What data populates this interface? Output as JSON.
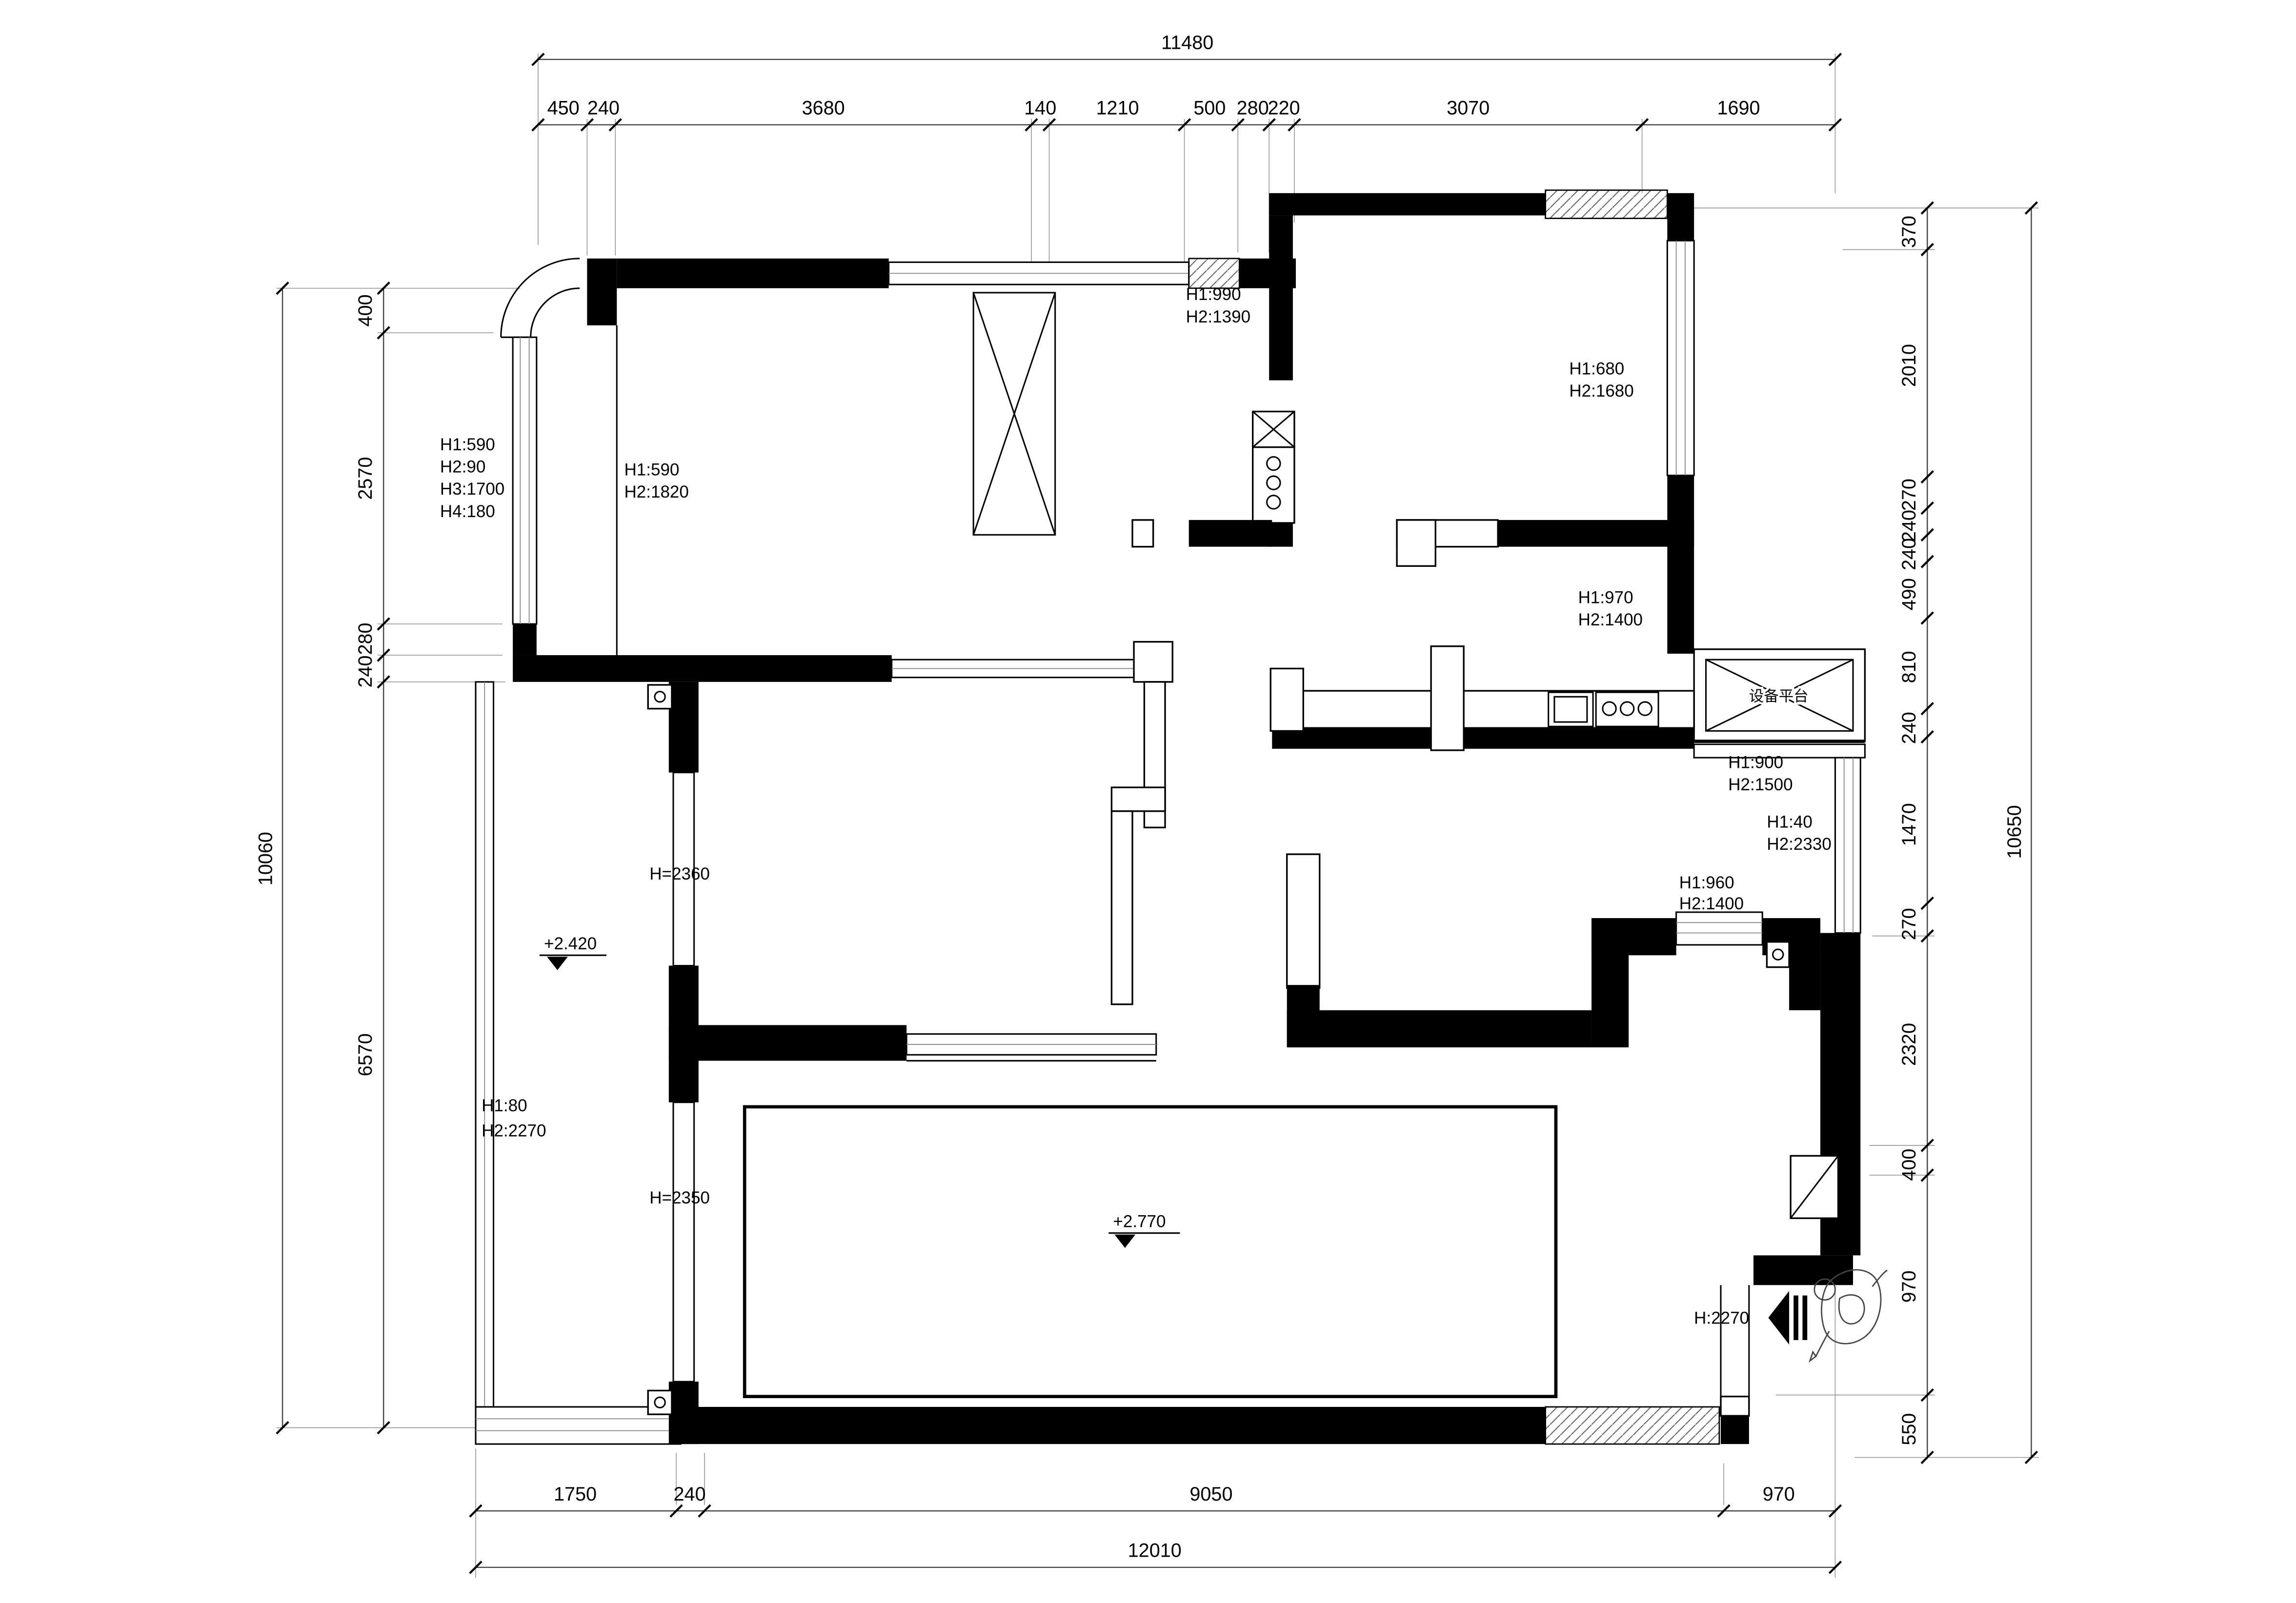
{
  "drawing_type": "floor-plan",
  "dims": {
    "top_total": "11480",
    "top_segments": [
      "450",
      "240",
      "3680",
      "140",
      "1210",
      "500",
      "280",
      "220",
      "3070",
      "1690"
    ],
    "bottom_segments": [
      "1750",
      "240",
      "9050",
      "970"
    ],
    "bottom_total": "12010",
    "left_outer_total": "10060",
    "left_segments": [
      "400",
      "2570",
      "280",
      "240",
      "6570"
    ],
    "right_outer_total": "10650",
    "right_segments": [
      "370",
      "2010",
      "270",
      "240",
      "240",
      "490",
      "810",
      "240",
      "1470",
      "270",
      "2320",
      "400",
      "970",
      "550"
    ]
  },
  "annotations": {
    "win_top_center": [
      "H1:990",
      "H2:1390"
    ],
    "win_top_right": [
      "H1:680",
      "H2:1680"
    ],
    "win_left_upper": [
      "H1:590",
      "H2:90",
      "H3:1700",
      "H4:180"
    ],
    "win_topleft_room": [
      "H1:590",
      "H2:1820"
    ],
    "win_mid_right": [
      "H1:970",
      "H2:1400"
    ],
    "win_platform": [
      "H1:900",
      "H2:1500"
    ],
    "win_right_balcony": [
      "H1:40",
      "H2:2330"
    ],
    "win_right_bedroom": [
      "H1:960",
      "H2:1400"
    ],
    "win_left_balcony": [
      "H1:80",
      "H2:2270"
    ],
    "entry_door_height": "H:2270"
  },
  "room_heights": {
    "hall": "H=2360",
    "living": "H=2350"
  },
  "elevations": {
    "left_balcony": "+2.420",
    "living": "+2.770"
  },
  "labels": {
    "equipment_platform": "设备平台"
  }
}
